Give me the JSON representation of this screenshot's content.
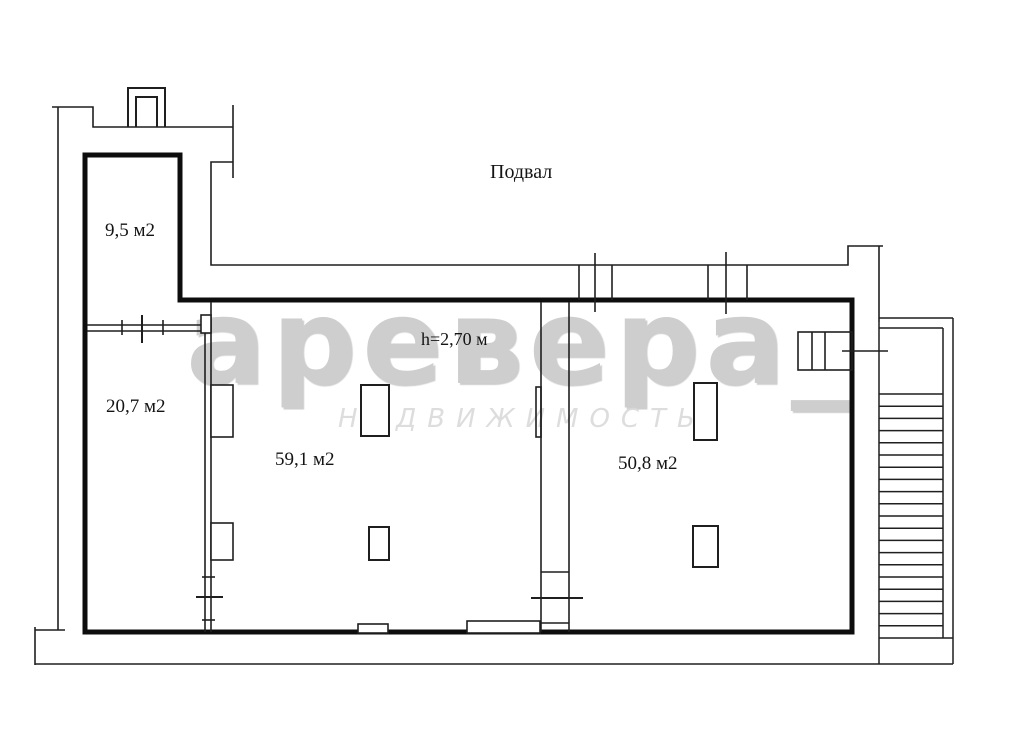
{
  "plan": {
    "floor_label": "Подвал",
    "rooms": [
      {
        "id": "room-9-5",
        "area_label": "9,5 м2"
      },
      {
        "id": "room-20-7",
        "area_label": "20,7 м2"
      },
      {
        "id": "room-59-1",
        "area_label": "59,1 м2"
      },
      {
        "id": "room-50-8",
        "area_label": "50,8 м2"
      }
    ],
    "annotations": {
      "ceiling_height": "h=2,70 м"
    }
  },
  "watermark": {
    "brand": "аревера_",
    "subtitle": "НЕДВИЖИМОСТЬ",
    "brand_color": "#c6c6c6",
    "subtitle_color": "#dadada"
  },
  "colors": {
    "line": "#1a1a1a",
    "thick_wall": "#0d0d0d",
    "background": "#ffffff"
  }
}
